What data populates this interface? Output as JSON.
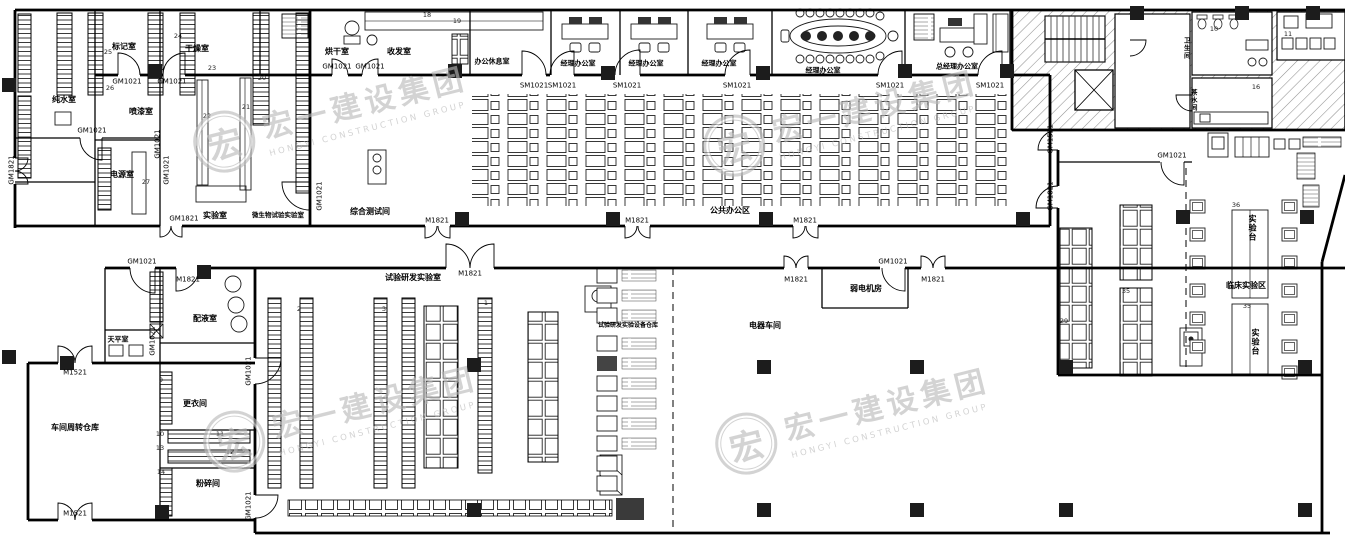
{
  "drawing": {
    "type": "architectural-floor-plan",
    "discipline": "laboratory-office building layout"
  },
  "colors": {
    "background": "#ffffff",
    "wall": "#000000",
    "column": "#1c1c1c",
    "hatch": "#8a8a8a",
    "watermark": "#b9b9b9"
  },
  "watermark": {
    "logo_char": "宏",
    "cn": "宏一建设集团",
    "en": "HONGYI CONSTRUCTION GROUP",
    "positions": [
      {
        "x": 320,
        "y": 118,
        "rot": -14
      },
      {
        "x": 830,
        "y": 122,
        "rot": -14
      },
      {
        "x": 330,
        "y": 418,
        "rot": -14
      },
      {
        "x": 842,
        "y": 420,
        "rot": -14
      }
    ]
  },
  "door_codes": [
    {
      "t": "GM1021",
      "x": 127,
      "y": 82
    },
    {
      "t": "GM1021",
      "x": 172,
      "y": 82
    },
    {
      "t": "GM1021",
      "x": 92,
      "y": 131
    },
    {
      "t": "GM1021",
      "x": 158,
      "y": 144,
      "r": -90
    },
    {
      "t": "GM1021",
      "x": 167,
      "y": 170,
      "r": -90
    },
    {
      "t": "GM1821",
      "x": 12,
      "y": 170,
      "r": -90
    },
    {
      "t": "GM1021",
      "x": 337,
      "y": 67
    },
    {
      "t": "GM1021",
      "x": 370,
      "y": 67
    },
    {
      "t": "GM1021",
      "x": 320,
      "y": 196,
      "r": -90
    },
    {
      "t": "GM1821",
      "x": 184,
      "y": 219
    },
    {
      "t": "SM1021",
      "x": 534,
      "y": 86
    },
    {
      "t": "SM1021",
      "x": 562,
      "y": 86
    },
    {
      "t": "SM1021",
      "x": 627,
      "y": 86
    },
    {
      "t": "SM1021",
      "x": 737,
      "y": 86
    },
    {
      "t": "SM1021",
      "x": 890,
      "y": 86
    },
    {
      "t": "SM1021",
      "x": 990,
      "y": 86
    },
    {
      "t": "M1821",
      "x": 437,
      "y": 221
    },
    {
      "t": "M1821",
      "x": 637,
      "y": 221
    },
    {
      "t": "M1821",
      "x": 805,
      "y": 221
    },
    {
      "t": "M1821",
      "x": 470,
      "y": 274
    },
    {
      "t": "M1821",
      "x": 796,
      "y": 280
    },
    {
      "t": "M1821",
      "x": 933,
      "y": 280
    },
    {
      "t": "GM1021",
      "x": 893,
      "y": 262
    },
    {
      "t": "GM1021",
      "x": 142,
      "y": 262
    },
    {
      "t": "M1821",
      "x": 188,
      "y": 280
    },
    {
      "t": "M1521",
      "x": 75,
      "y": 373
    },
    {
      "t": "M1521",
      "x": 75,
      "y": 514
    },
    {
      "t": "GM1021",
      "x": 153,
      "y": 341,
      "r": -90
    },
    {
      "t": "GM1021",
      "x": 249,
      "y": 371,
      "r": -90
    },
    {
      "t": "GM1021",
      "x": 249,
      "y": 506,
      "r": -90
    },
    {
      "t": "GM1521",
      "x": 1051,
      "y": 139,
      "r": -90
    },
    {
      "t": "GM1821",
      "x": 1051,
      "y": 196,
      "r": -90
    },
    {
      "t": "GM1021",
      "x": 1172,
      "y": 156
    }
  ],
  "room_labels": [
    {
      "t": "纯水室",
      "x": 64,
      "y": 100
    },
    {
      "t": "标记室",
      "x": 124,
      "y": 47
    },
    {
      "t": "干燥室",
      "x": 197,
      "y": 49
    },
    {
      "t": "喷漆室",
      "x": 141,
      "y": 112
    },
    {
      "t": "电源室",
      "x": 122,
      "y": 175
    },
    {
      "t": "实验室",
      "x": 215,
      "y": 216
    },
    {
      "t": "微生物试验实验室",
      "x": 278,
      "y": 215,
      "s": 6.5
    },
    {
      "t": "综合测试间",
      "x": 370,
      "y": 212
    },
    {
      "t": "烘干室",
      "x": 337,
      "y": 52
    },
    {
      "t": "收发室",
      "x": 399,
      "y": 52
    },
    {
      "t": "办公休息室",
      "x": 492,
      "y": 62,
      "s": 7
    },
    {
      "t": "经理办公室",
      "x": 578,
      "y": 64,
      "s": 7
    },
    {
      "t": "经理办公室",
      "x": 646,
      "y": 64,
      "s": 7
    },
    {
      "t": "经理办公室",
      "x": 719,
      "y": 64,
      "s": 7
    },
    {
      "t": "经理办公室",
      "x": 823,
      "y": 71,
      "s": 7
    },
    {
      "t": "总经理办公室",
      "x": 957,
      "y": 67,
      "s": 7
    },
    {
      "t": "公共办公区",
      "x": 730,
      "y": 211
    },
    {
      "t": "弱电机房",
      "x": 866,
      "y": 289
    },
    {
      "t": "电器车间",
      "x": 765,
      "y": 326
    },
    {
      "t": "试验研发实验室",
      "x": 413,
      "y": 278
    },
    {
      "t": "试验研发实验设备仓库",
      "x": 628,
      "y": 326,
      "s": 6
    },
    {
      "t": "车间周转仓库",
      "x": 75,
      "y": 428
    },
    {
      "t": "天平室",
      "x": 118,
      "y": 340,
      "s": 7
    },
    {
      "t": "配液室",
      "x": 205,
      "y": 319
    },
    {
      "t": "更衣间",
      "x": 195,
      "y": 404
    },
    {
      "t": "粉碎间",
      "x": 208,
      "y": 484
    },
    {
      "t": "卫生间",
      "x": 1186,
      "y": 48,
      "v": true,
      "s": 6.5
    },
    {
      "t": "茶水间",
      "x": 1193,
      "y": 100,
      "v": true,
      "s": 6.5
    },
    {
      "t": "临床实验区",
      "x": 1246,
      "y": 286
    },
    {
      "t": "实验台",
      "x": 1252,
      "y": 228,
      "v": true
    },
    {
      "t": "实验台",
      "x": 1255,
      "y": 342,
      "v": true
    }
  ],
  "ref_numbers": [
    {
      "t": "18",
      "x": 427,
      "y": 15
    },
    {
      "t": "19",
      "x": 457,
      "y": 21
    },
    {
      "t": "24",
      "x": 178,
      "y": 36
    },
    {
      "t": "25",
      "x": 108,
      "y": 52
    },
    {
      "t": "23",
      "x": 212,
      "y": 68
    },
    {
      "t": "20",
      "x": 262,
      "y": 78
    },
    {
      "t": "26",
      "x": 110,
      "y": 88
    },
    {
      "t": "21",
      "x": 246,
      "y": 107
    },
    {
      "t": "22",
      "x": 207,
      "y": 116
    },
    {
      "t": "27",
      "x": 146,
      "y": 182
    },
    {
      "t": "9",
      "x": 161,
      "y": 380
    },
    {
      "t": "10",
      "x": 160,
      "y": 434
    },
    {
      "t": "11",
      "x": 220,
      "y": 434
    },
    {
      "t": "13",
      "x": 160,
      "y": 448
    },
    {
      "t": "12",
      "x": 230,
      "y": 452
    },
    {
      "t": "14",
      "x": 161,
      "y": 472
    },
    {
      "t": "10",
      "x": 1214,
      "y": 29
    },
    {
      "t": "11",
      "x": 1288,
      "y": 34
    },
    {
      "t": "16",
      "x": 1256,
      "y": 87
    },
    {
      "t": "29",
      "x": 1064,
      "y": 321
    },
    {
      "t": "35",
      "x": 1126,
      "y": 291
    },
    {
      "t": "36",
      "x": 1236,
      "y": 205
    },
    {
      "t": "35",
      "x": 1247,
      "y": 306
    },
    {
      "t": "1",
      "x": 486,
      "y": 303
    },
    {
      "t": "2",
      "x": 299,
      "y": 309
    },
    {
      "t": "3",
      "x": 384,
      "y": 309
    }
  ]
}
